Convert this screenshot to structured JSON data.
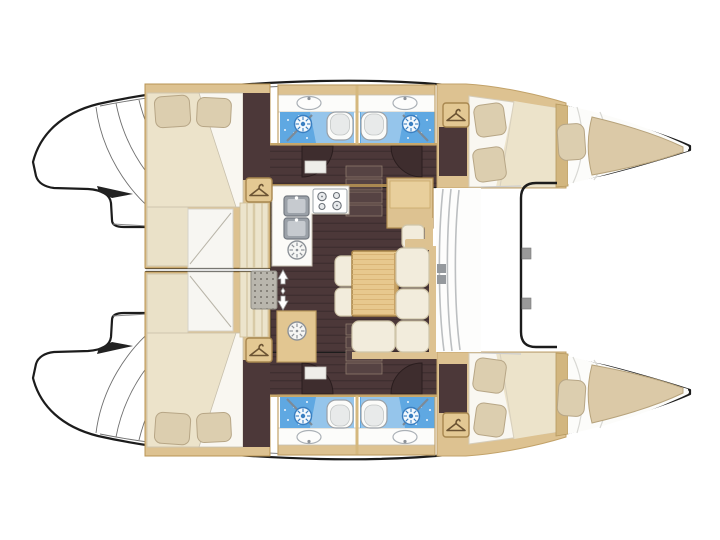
{
  "figure": {
    "title": "Catamaran interior layout plan, top view with bow to the right",
    "orientation": {
      "bow": "right",
      "stern": "left",
      "port_hull": "top",
      "starboard_hull": "bottom"
    },
    "visible_text": []
  },
  "palette": {
    "background": "#ffffff",
    "outline": "#1c1c1c",
    "wood_tan": "#ddc291",
    "wood_tan_dark": "#b99454",
    "floor_brown": "#4c3839",
    "floor_brown_dark": "#3f2f30",
    "table_wood": "#e7c88e",
    "upholstery_cream": "#f2ecdc",
    "upholstery_edge": "#cfc5a9",
    "pillow_beige": "#dcceaf",
    "pillow_edge": "#b7a686",
    "bed_white": "#f9f7f1",
    "blanket_cream": "#ece3ca",
    "bathroom_blue": "#5fa8e2",
    "bathroom_blue_light": "#a7cfee",
    "bathroom_blue_dark": "#3a7fc1",
    "fixture_white": "#fbfbf9",
    "fixture_gray": "#9ba1a8",
    "mat_gray": "#b9b6ad",
    "line_gray": "#c2c2c0"
  },
  "icons": [
    {
      "name": "hanger-icon",
      "meaning": "hanging locker / wardrobe",
      "count": 4
    },
    {
      "name": "shower-head-icon",
      "meaning": "shower",
      "count": 4
    },
    {
      "name": "toilet-icon",
      "meaning": "marine toilet",
      "count": 4
    },
    {
      "name": "washbasin-icon",
      "meaning": "bathroom sink",
      "count": 4
    },
    {
      "name": "galley-sink-icon",
      "meaning": "double galley sink",
      "count": 2
    },
    {
      "name": "stove-burners-icon",
      "meaning": "cooktop burners",
      "count": 1
    },
    {
      "name": "fridge-vent-icon",
      "meaning": "top-loading fridge / freezer",
      "count": 2
    },
    {
      "name": "companionway-arrows-icon",
      "meaning": "entry direction arrows",
      "count": 1
    },
    {
      "name": "non-skid-mat",
      "meaning": "companionway entry mat",
      "count": 1
    }
  ],
  "areas": {
    "port_hull": [
      "aft double cabin",
      "aft bathroom with shower",
      "forward bathroom with shower",
      "forward double cabin",
      "bow berth"
    ],
    "starboard_hull": [
      "aft double cabin",
      "aft bathroom with shower",
      "forward bathroom with shower",
      "forward double cabin",
      "bow berth"
    ],
    "bridgedeck_salon": [
      "L-shaped galley",
      "chart table with seat",
      "dinette table",
      "L-shaped sofa",
      "two stools",
      "cold storage cabinet",
      "companionway steps"
    ],
    "exterior": [
      "aft transom steps",
      "front windows",
      "foredeck beam",
      "trampoline area"
    ]
  }
}
